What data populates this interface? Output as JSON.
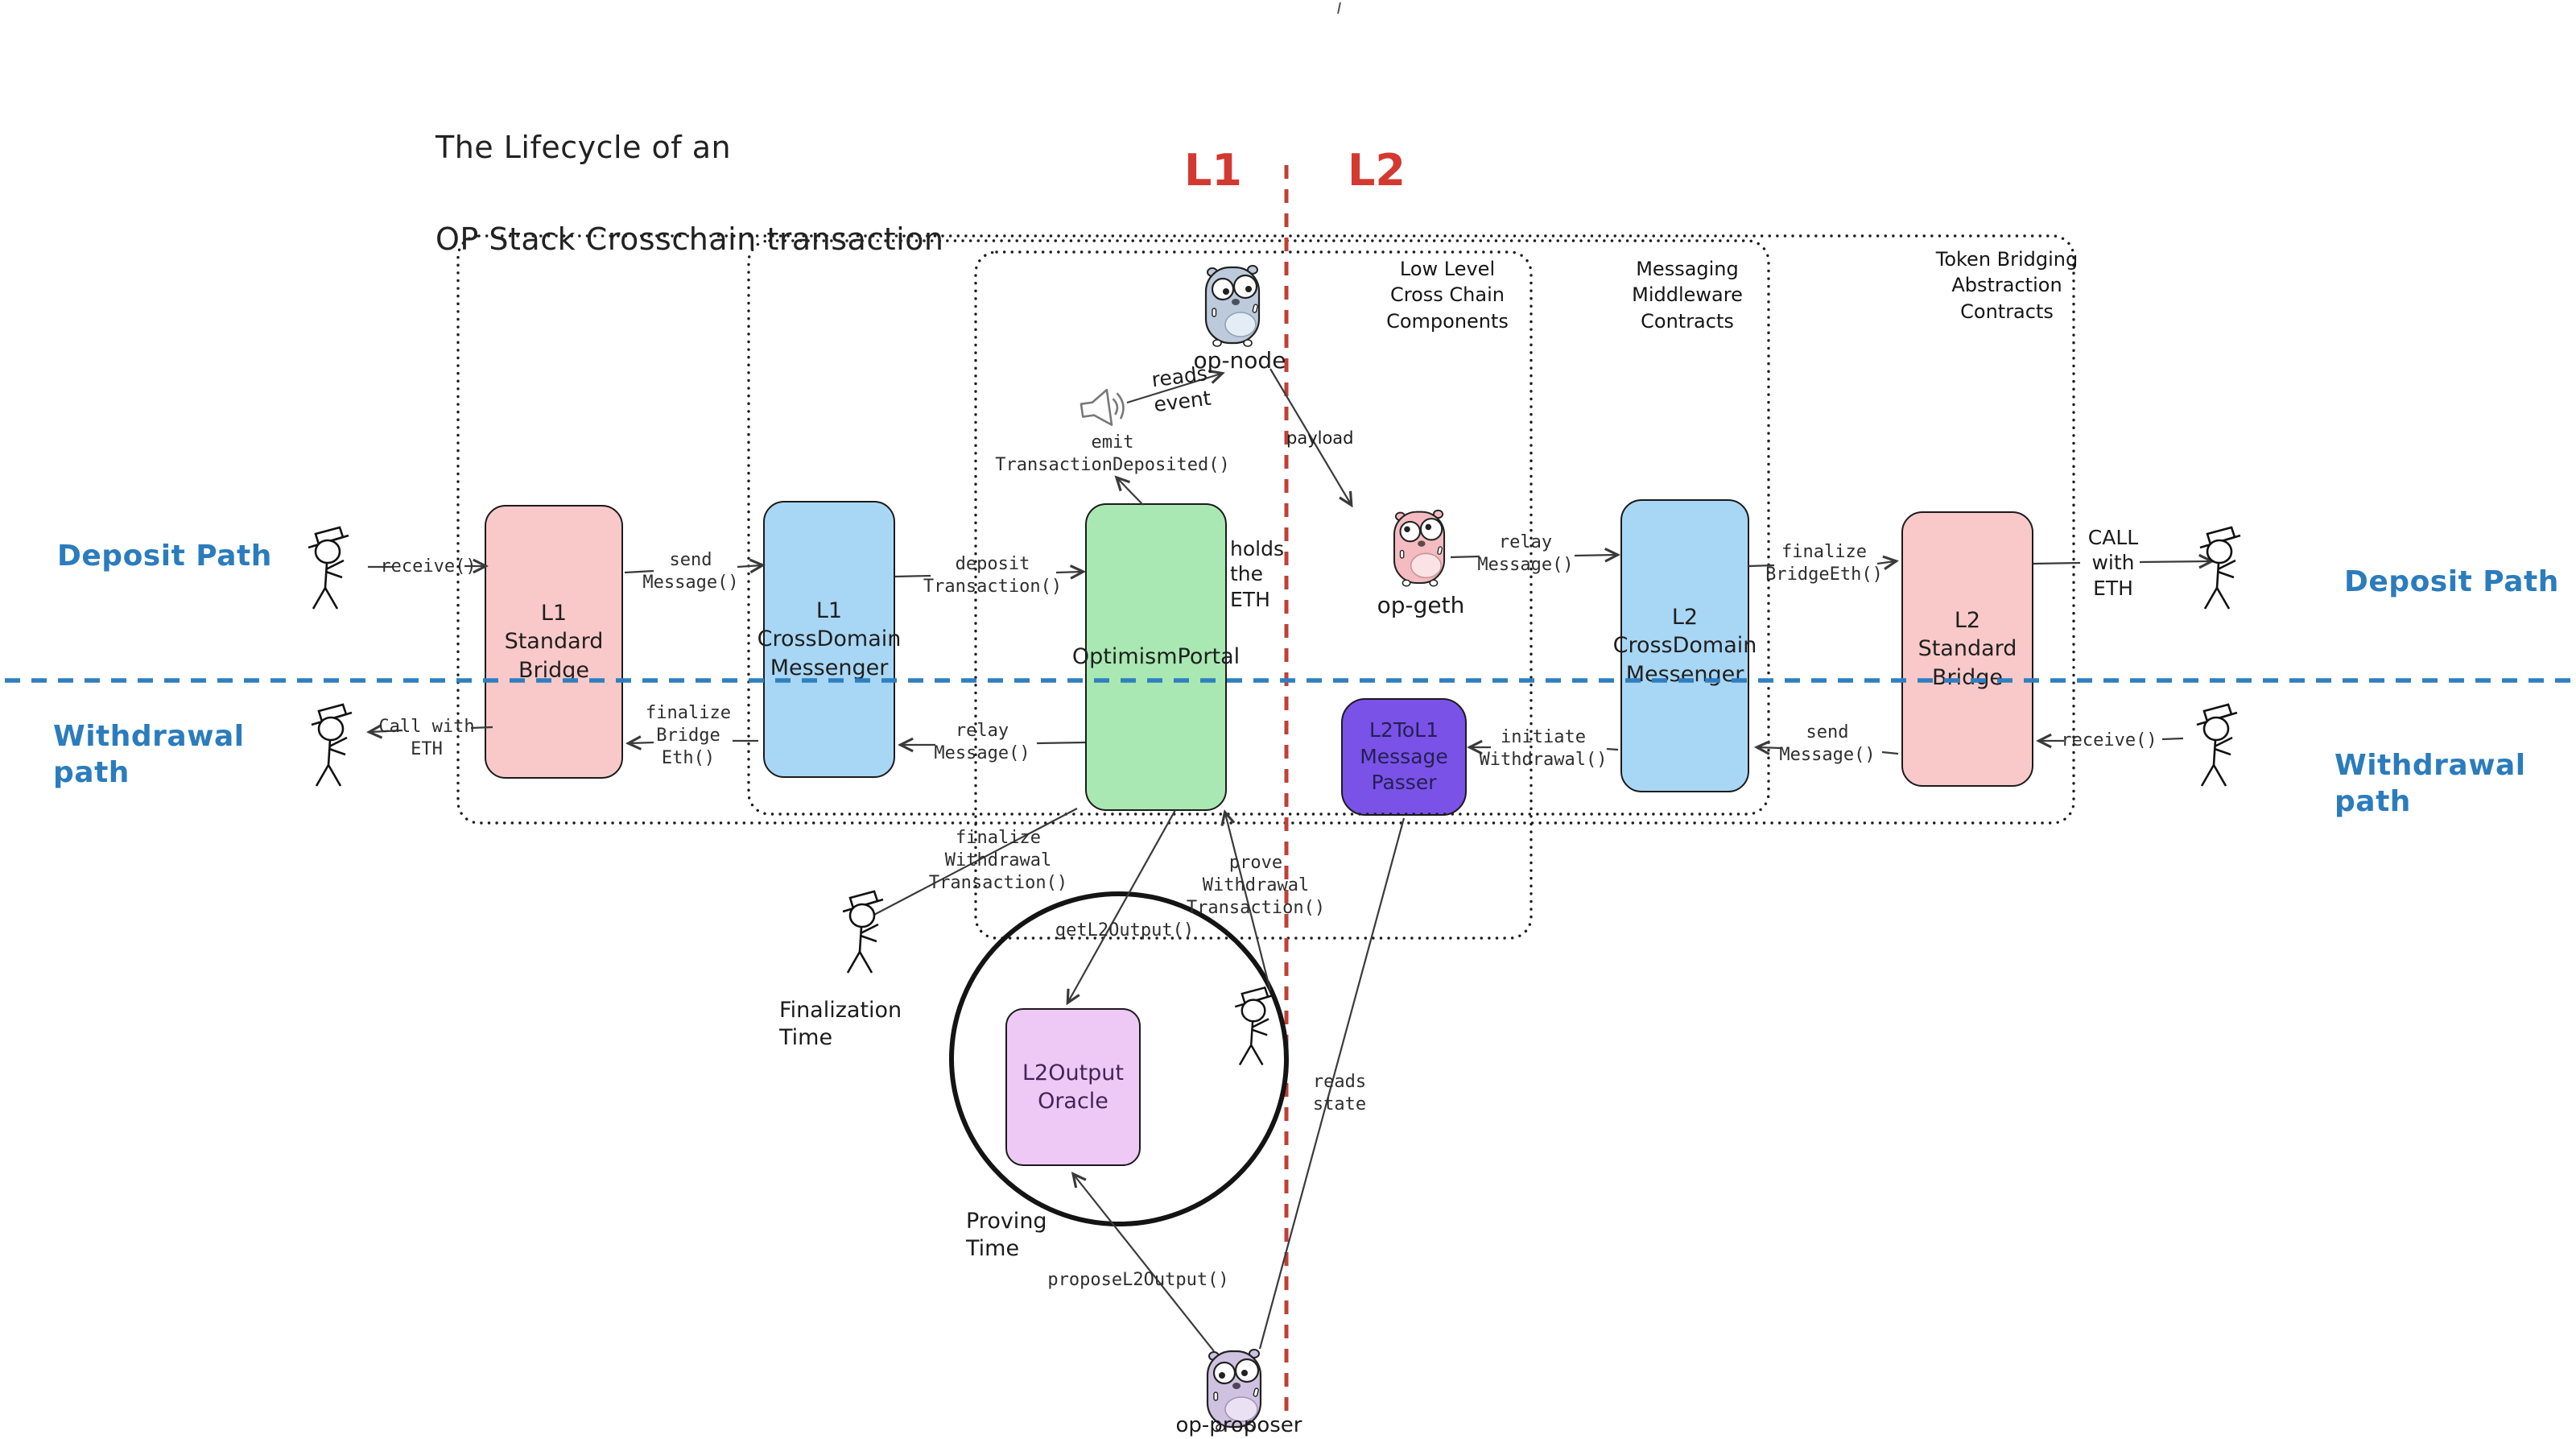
{
  "title": {
    "line1": "The Lifecycle of an",
    "line2": "OP Stack Crosschain transaction"
  },
  "layers": {
    "l1": "L1",
    "l2": "L2"
  },
  "paths": {
    "deposit_left": "Deposit Path",
    "withdrawal_left": "Withdrawal path",
    "deposit_right": "Deposit Path",
    "withdrawal_right": "Withdrawal path"
  },
  "groups": {
    "low_level": "Low Level\nCross Chain\nComponents",
    "messaging": "Messaging\nMiddleware\nContracts",
    "token_bridging": "Token Bridging\nAbstraction\nContracts"
  },
  "boxes": {
    "l1_standard_bridge": "L1\nStandard\nBridge",
    "l1_crossdomain_messenger": "L1\nCrossDomain\nMessenger",
    "optimism_portal": "OptimismPortal",
    "l2tol1_message_passer": "L2ToL1\nMessage\nPasser",
    "l2_crossdomain_messenger": "L2\nCrossDomain\nMessenger",
    "l2_standard_bridge": "L2\nStandard\nBridge",
    "l2output_oracle": "L2Output\nOracle"
  },
  "actors": {
    "op_node": "op-node",
    "op_geth": "op-geth",
    "op_proposer": "op-proposer"
  },
  "calls": {
    "receive_deposit": "receive()",
    "send_message_deposit": "send\nMessage()",
    "deposit_transaction": "deposit\nTransaction()",
    "emit_transaction_deposited": "emit\nTransactionDeposited()",
    "relay_message_deposit": "relay\nMessage()",
    "finalize_bridgeeth": "finalize\nBridgeEth()",
    "receive_withdrawal": "receive()",
    "send_message_withdrawal": "send\nMessage()",
    "initiate_withdrawal": "initiate\nWithdrawal()",
    "relay_message_withdrawal": "relay\nMessage()",
    "finalize_bridge_eth": "finalize\nBridge\nEth()",
    "call_with_eth_left": "Call with\nETH",
    "finalize_withdrawal_transaction": "finalize\nWithdrawal\nTransaction()",
    "prove_withdrawal_transaction": "prove\nWithdrawal\nTransaction()",
    "get_l2_output": "getL2Output()",
    "propose_l2_output": "proposeL2Output()",
    "reads_state": "reads\nstate"
  },
  "annotations": {
    "reads_event": "reads\nevent",
    "payload": "payload",
    "holds_the_eth": "holds\nthe\nETH",
    "call_with_eth_right": "CALL\nwith\nETH",
    "finalization_time": "Finalization\nTime",
    "proving_time": "Proving\nTime"
  },
  "colors": {
    "bridge_pink": "#f9c9c9",
    "messenger_blue": "#a8d7f5",
    "portal_green": "#a9e8b2",
    "passer_purple": "#7a52e8",
    "oracle_violet": "#efc9f5",
    "passer_text": "#241f52",
    "oracle_text": "#43245a",
    "divider_red": "#c04038",
    "divider_blue": "#2f7fc0",
    "path_label_blue": "#2b7cbd",
    "layer_label_red": "#d23a31"
  }
}
